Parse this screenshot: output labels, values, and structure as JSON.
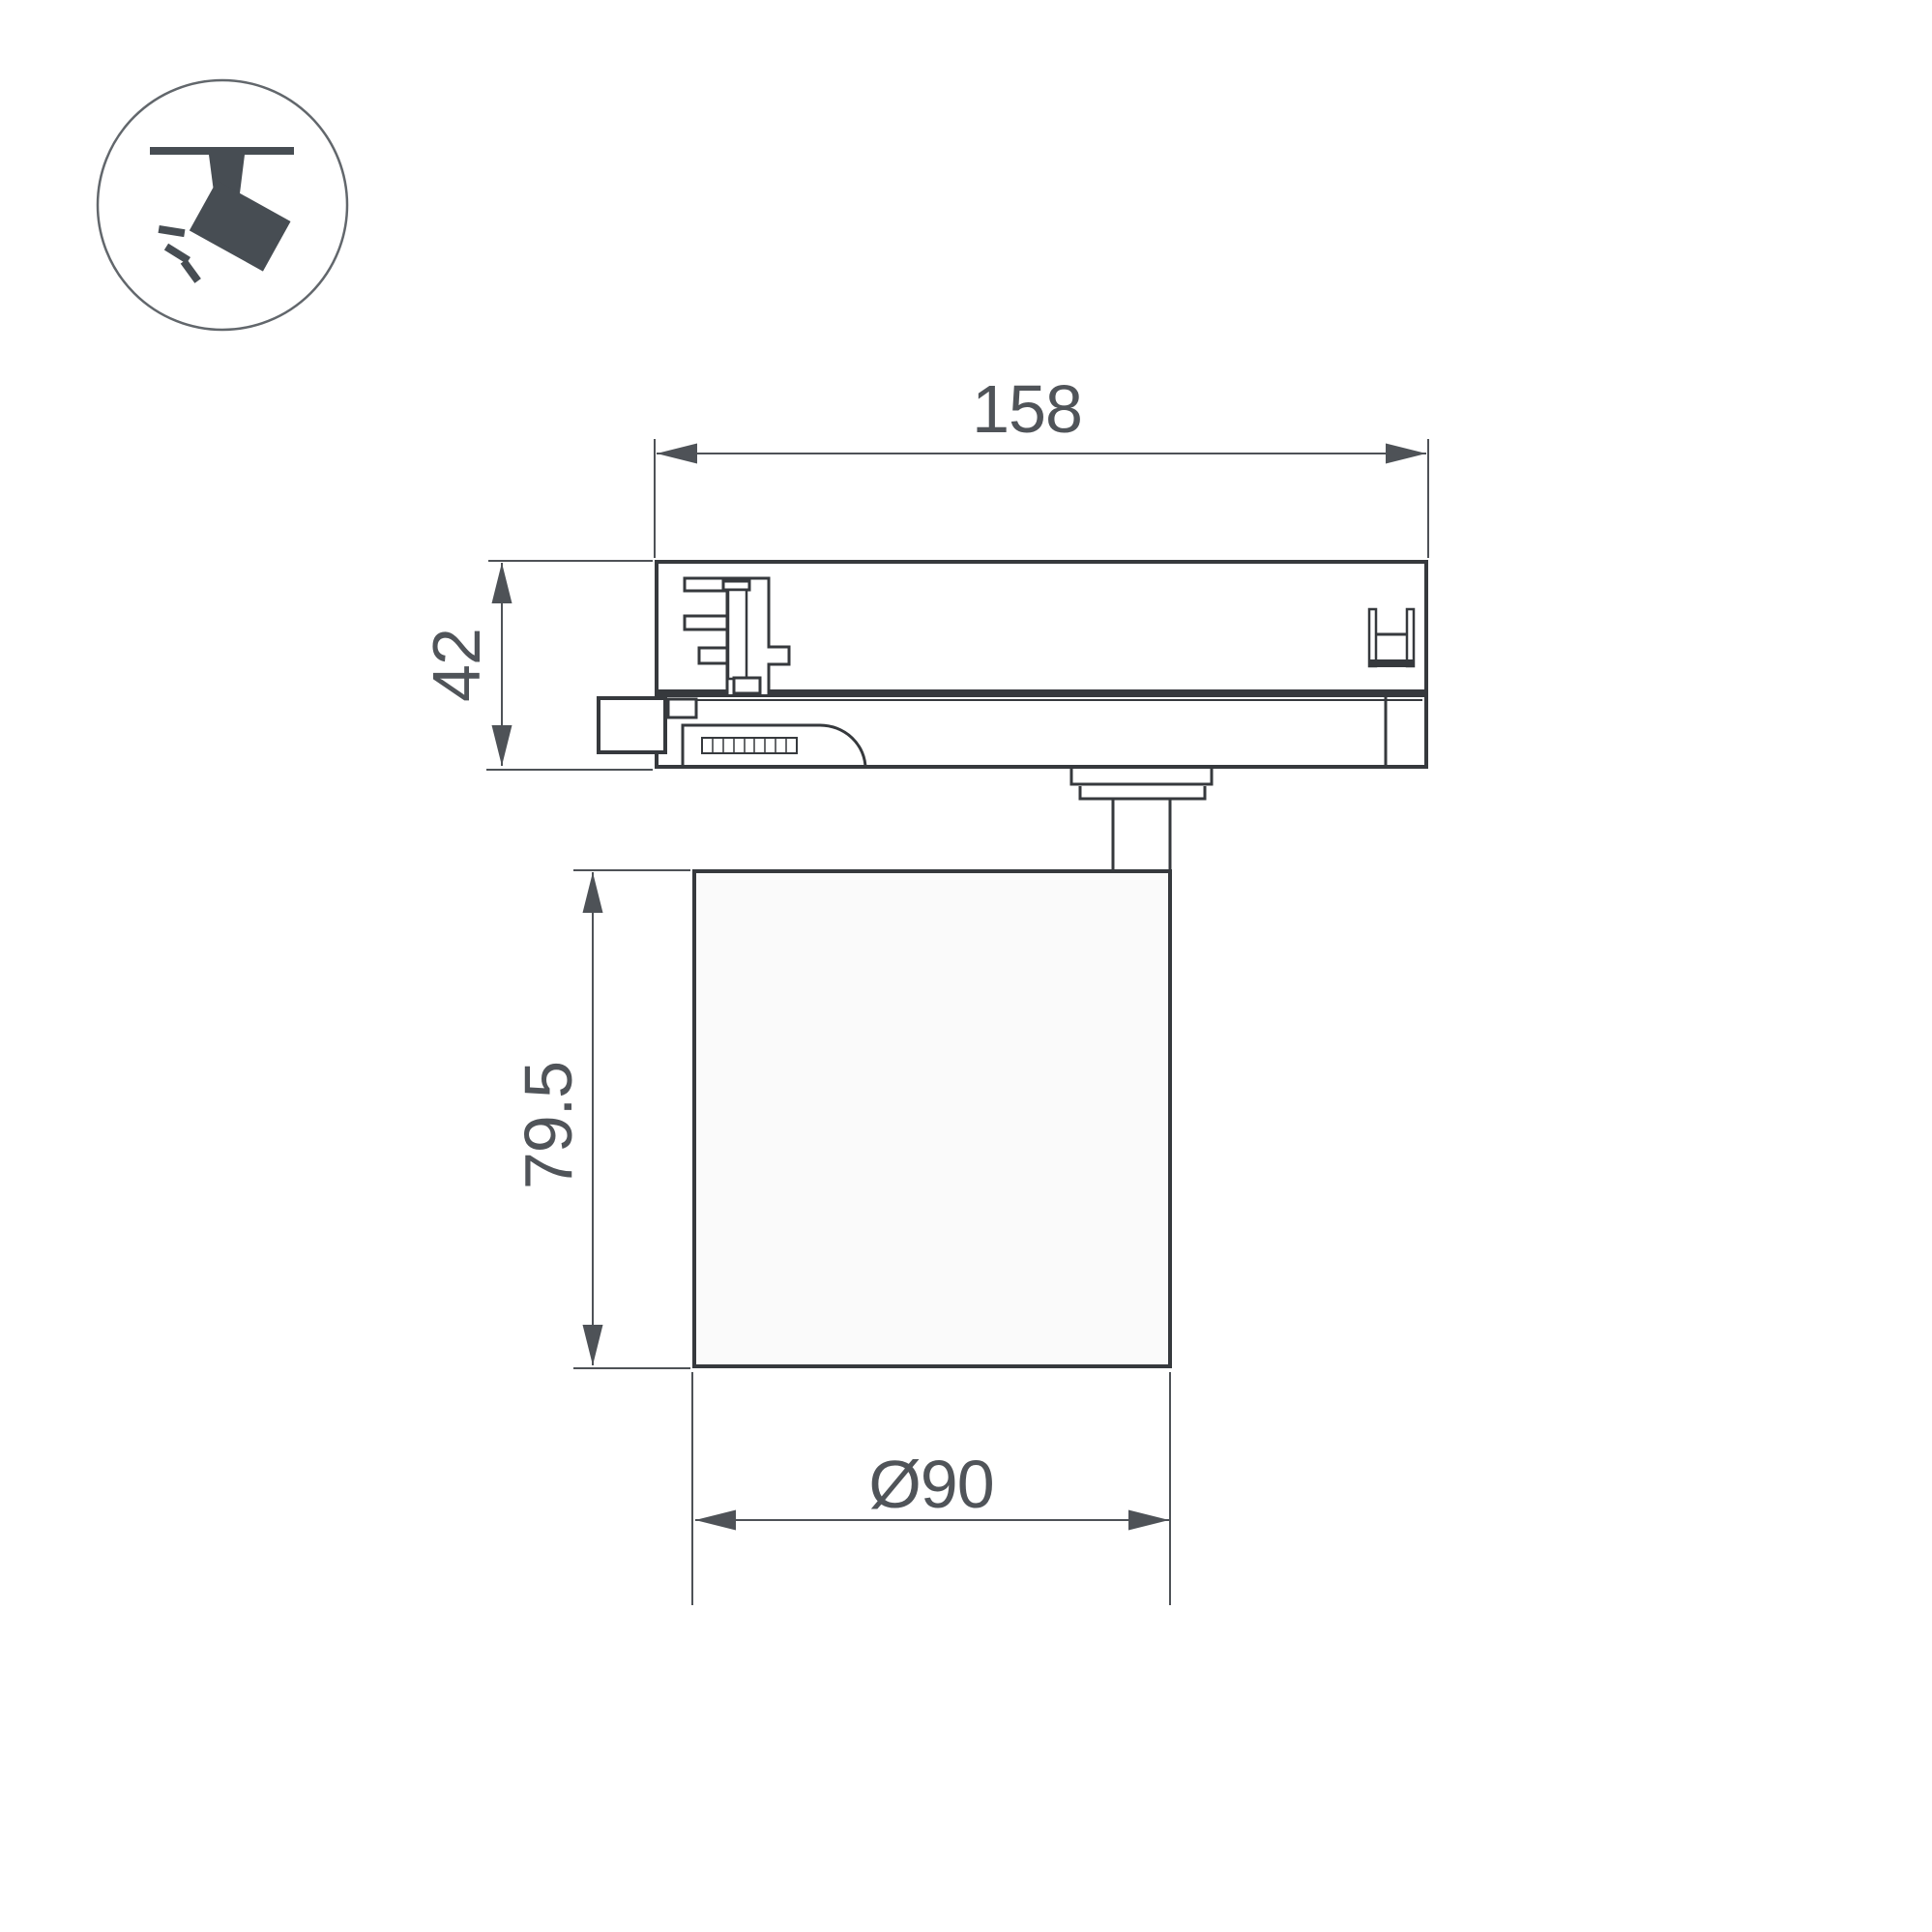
{
  "page": {
    "background": "#ffffff"
  },
  "icon": {
    "semantic": "track-spotlight-icon",
    "color": "#474d53",
    "circle_stroke": "#62676c"
  },
  "drawing": {
    "line_color": "#36393d",
    "dim_color": "#4e5257",
    "text_color": "#505459",
    "lamp_fill": "#fafafa",
    "dimensions": {
      "track_width": {
        "label": "158"
      },
      "adapter_height": {
        "label": "42"
      },
      "body_height": {
        "label": "79.5"
      },
      "body_diameter": {
        "label": "Ø90"
      }
    }
  }
}
